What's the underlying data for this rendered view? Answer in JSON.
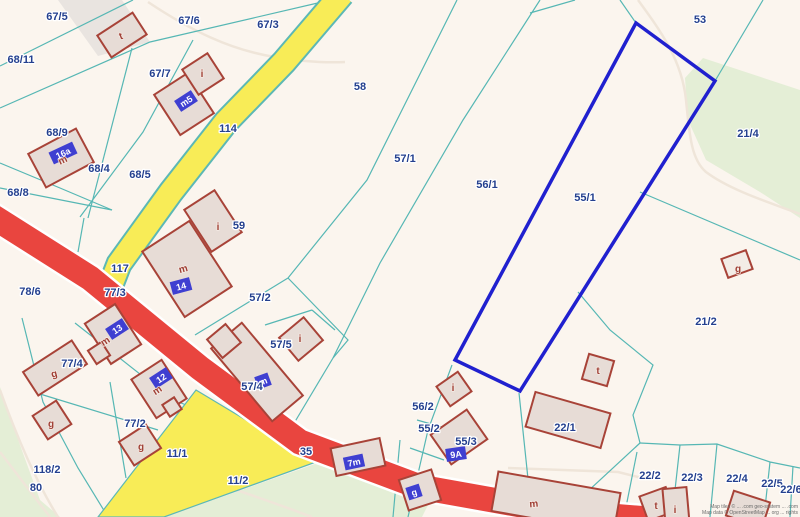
{
  "map": {
    "colors": {
      "background": "#fbf5ee",
      "green": "#e4eed6",
      "gray_band": "#e9e4e0",
      "parcel_line": "#56b7b4",
      "road_yellow": "#f8ec57",
      "road_yellow_casing": "#5cb8b5",
      "road_red": "#e9453f",
      "road_red_casing": "#ffffff",
      "selected_outline": "#2020cf",
      "building_fill": "#e7dcd6",
      "building_stroke": "#a84338",
      "badge_fill": "#3f3fd1",
      "label_color": "#24408f",
      "letter_color": "#a04036",
      "path_color": "#efe5d9"
    },
    "areas": [
      {
        "name": "green-area-bottom-left",
        "points": [
          [
            0,
            387
          ],
          [
            20,
            445
          ],
          [
            40,
            500
          ],
          [
            60,
            517
          ],
          [
            0,
            517
          ]
        ],
        "fill": "#e4eed6"
      },
      {
        "name": "green-area-parcel-11-2",
        "points": [
          [
            165,
            517
          ],
          [
            315,
            464
          ],
          [
            430,
            501
          ],
          [
            422,
            517
          ]
        ],
        "fill": "#e4eed6"
      },
      {
        "name": "green-area-top-right",
        "points": [
          [
            703,
            58
          ],
          [
            800,
            90
          ],
          [
            800,
            218
          ],
          [
            760,
            192
          ],
          [
            706,
            160
          ],
          [
            688,
            120
          ],
          [
            685,
            78
          ]
        ],
        "fill": "#e4eed6"
      },
      {
        "name": "gray-track-top-left",
        "points": [
          [
            58,
            0
          ],
          [
            122,
            0
          ],
          [
            150,
            42
          ],
          [
            98,
            56
          ]
        ],
        "fill": "#e9e4e0"
      }
    ],
    "faint_paths": [
      {
        "name": "path-top-left",
        "d": "M148,2 C190,30 230,50 275,57 C305,62 325,63 345,62"
      },
      {
        "name": "path-near-53",
        "d": "M638,0 C660,30 682,60 686,100 C690,140 692,160 706,172 C730,190 768,202 800,214"
      },
      {
        "name": "path-green-edge",
        "d": "M0,390 C18,440 38,485 58,517"
      },
      {
        "name": "path-green-inner",
        "d": "M0,452 C20,478 35,498 50,517"
      },
      {
        "name": "path-green-11-2",
        "d": "M180,472 C230,487 272,502 312,517"
      },
      {
        "name": "path-above-building-m",
        "d": "M508,468 L618,472 L642,478"
      }
    ],
    "parcel_lines": [
      [
        [
          0,
          66
        ],
        [
          133,
          0
        ]
      ],
      [
        [
          0,
          108
        ],
        [
          150,
          42
        ],
        [
          322,
          2
        ]
      ],
      [
        [
          0,
          188
        ],
        [
          112,
          210
        ]
      ],
      [
        [
          0,
          163
        ],
        [
          60,
          188
        ],
        [
          112,
          210
        ]
      ],
      [
        [
          132,
          48
        ],
        [
          88,
          218
        ]
      ],
      [
        [
          193,
          40
        ],
        [
          143,
          132
        ],
        [
          80,
          217
        ]
      ],
      [
        [
          84,
          218
        ],
        [
          78,
          252
        ]
      ],
      [
        [
          457,
          0
        ],
        [
          367,
          180
        ],
        [
          288,
          278
        ]
      ],
      [
        [
          540,
          0
        ],
        [
          463,
          120
        ],
        [
          380,
          263
        ],
        [
          333,
          358
        ]
      ],
      [
        [
          530,
          13
        ],
        [
          575,
          0
        ]
      ],
      [
        [
          620,
          0
        ],
        [
          636,
          23
        ]
      ],
      [
        [
          715,
          81
        ],
        [
          763,
          0
        ]
      ],
      [
        [
          640,
          192
        ],
        [
          800,
          260
        ]
      ],
      [
        [
          578,
          292
        ],
        [
          610,
          330
        ],
        [
          653,
          365
        ],
        [
          633,
          415
        ],
        [
          640,
          443
        ]
      ],
      [
        [
          640,
          443
        ],
        [
          560,
          517
        ]
      ],
      [
        [
          637,
          452
        ],
        [
          624,
          517
        ]
      ],
      [
        [
          640,
          443
        ],
        [
          680,
          445
        ],
        [
          717,
          444
        ],
        [
          770,
          462
        ],
        [
          800,
          468
        ]
      ],
      [
        [
          680,
          445
        ],
        [
          672,
          517
        ]
      ],
      [
        [
          717,
          444
        ],
        [
          710,
          517
        ]
      ],
      [
        [
          770,
          462
        ],
        [
          764,
          517
        ]
      ],
      [
        [
          793,
          466
        ],
        [
          790,
          517
        ]
      ],
      [
        [
          288,
          278
        ],
        [
          195,
          335
        ]
      ],
      [
        [
          288,
          278
        ],
        [
          348,
          340
        ],
        [
          333,
          358
        ]
      ],
      [
        [
          333,
          358
        ],
        [
          290,
          430
        ]
      ],
      [
        [
          452,
          365
        ],
        [
          428,
          430
        ],
        [
          412,
          500
        ],
        [
          408,
          517
        ]
      ],
      [
        [
          400,
          440
        ],
        [
          393,
          517
        ]
      ],
      [
        [
          417,
          420
        ],
        [
          452,
          430
        ]
      ],
      [
        [
          410,
          448
        ],
        [
          444,
          460
        ]
      ],
      [
        [
          519,
          393
        ],
        [
          532,
          517
        ]
      ],
      [
        [
          22,
          318
        ],
        [
          43,
          402
        ],
        [
          78,
          468
        ],
        [
          108,
          517
        ]
      ],
      [
        [
          40,
          394
        ],
        [
          158,
          430
        ]
      ],
      [
        [
          75,
          323
        ],
        [
          173,
          400
        ],
        [
          205,
          412
        ]
      ],
      [
        [
          110,
          382
        ],
        [
          126,
          478
        ]
      ],
      [
        [
          265,
          325
        ],
        [
          312,
          310
        ]
      ],
      [
        [
          312,
          310
        ],
        [
          335,
          330
        ]
      ]
    ],
    "roads": {
      "yellow_main": {
        "name": "road-yellow-114",
        "d": "M342,-6 L284,62 L226,122 L171,192 L119,264 L112,282",
        "width": 23,
        "casing": 27
      },
      "yellow_branch": {
        "name": "road-yellow-11-1",
        "points": [
          [
            196,
            390
          ],
          [
            316,
            462
          ],
          [
            164,
            517
          ],
          [
            98,
            517
          ]
        ]
      },
      "red_main": {
        "name": "road-red-35",
        "d": "M-8,216 L90,278 L200,368 L300,442 L420,487 L560,512 L648,519",
        "width": 25,
        "casing": 30
      }
    },
    "selected_parcel": {
      "label": "55/1",
      "points": [
        [
          636,
          23
        ],
        [
          715,
          81
        ],
        [
          520,
          391
        ],
        [
          455,
          360
        ]
      ]
    },
    "buildings": [
      {
        "cx": 122,
        "cy": 35,
        "w": 42,
        "h": 26,
        "rot": -33
      },
      {
        "cx": 184,
        "cy": 104,
        "w": 40,
        "h": 48,
        "rot": -33
      },
      {
        "cx": 203,
        "cy": 74,
        "w": 30,
        "h": 30,
        "rot": -33
      },
      {
        "cx": 61,
        "cy": 158,
        "w": 54,
        "h": 38,
        "rot": -28
      },
      {
        "cx": 213,
        "cy": 221,
        "w": 36,
        "h": 50,
        "rot": -33
      },
      {
        "cx": 187,
        "cy": 269,
        "w": 56,
        "h": 78,
        "rot": -33
      },
      {
        "cx": 113,
        "cy": 334,
        "w": 36,
        "h": 48,
        "rot": -33
      },
      {
        "cx": 99,
        "cy": 353,
        "w": 16,
        "h": 16,
        "rot": -33
      },
      {
        "cx": 159,
        "cy": 389,
        "w": 36,
        "h": 46,
        "rot": -33
      },
      {
        "cx": 172,
        "cy": 407,
        "w": 14,
        "h": 14,
        "rot": -33
      },
      {
        "cx": 55,
        "cy": 368,
        "w": 58,
        "h": 28,
        "rot": -33
      },
      {
        "cx": 52,
        "cy": 420,
        "w": 28,
        "h": 28,
        "rot": -33
      },
      {
        "cx": 140,
        "cy": 445,
        "w": 32,
        "h": 28,
        "rot": -33
      },
      {
        "cx": 257,
        "cy": 372,
        "w": 40,
        "h": 95,
        "rot": -40
      },
      {
        "cx": 224,
        "cy": 341,
        "w": 24,
        "h": 24,
        "rot": -40
      },
      {
        "cx": 301,
        "cy": 339,
        "w": 32,
        "h": 30,
        "rot": -40
      },
      {
        "cx": 358,
        "cy": 457,
        "w": 50,
        "h": 28,
        "rot": -12
      },
      {
        "cx": 420,
        "cy": 490,
        "w": 34,
        "h": 32,
        "rot": -18
      },
      {
        "cx": 459,
        "cy": 437,
        "w": 44,
        "h": 36,
        "rot": -35
      },
      {
        "cx": 454,
        "cy": 389,
        "w": 26,
        "h": 24,
        "rot": -35
      },
      {
        "cx": 568,
        "cy": 420,
        "w": 78,
        "h": 36,
        "rot": 16
      },
      {
        "cx": 598,
        "cy": 370,
        "w": 26,
        "h": 26,
        "rot": 16
      },
      {
        "cx": 556,
        "cy": 502,
        "w": 124,
        "h": 40,
        "rot": 10
      },
      {
        "cx": 657,
        "cy": 504,
        "w": 28,
        "h": 26,
        "rot": -20
      },
      {
        "cx": 676,
        "cy": 506,
        "w": 24,
        "h": 36,
        "rot": -5
      },
      {
        "cx": 748,
        "cy": 509,
        "w": 38,
        "h": 26,
        "rot": 18
      },
      {
        "cx": 737,
        "cy": 264,
        "w": 26,
        "h": 20,
        "rot": -20,
        "fill": "#f3ece6"
      }
    ],
    "address_badges": [
      {
        "text": "m5",
        "x": 186,
        "y": 101,
        "rot": -33
      },
      {
        "text": "16a",
        "x": 63,
        "y": 153,
        "rot": -25
      },
      {
        "text": "14",
        "x": 181,
        "y": 286,
        "rot": -15
      },
      {
        "text": "13",
        "x": 117,
        "y": 329,
        "rot": -33
      },
      {
        "text": "12",
        "x": 161,
        "y": 378,
        "rot": -33
      },
      {
        "text": "m",
        "x": 263,
        "y": 381,
        "rot": -20
      },
      {
        "text": "7m",
        "x": 354,
        "y": 462,
        "rot": -12
      },
      {
        "text": "g",
        "x": 414,
        "y": 492,
        "rot": -18
      },
      {
        "text": "9A",
        "x": 456,
        "y": 454,
        "rot": -8
      }
    ],
    "building_letters": [
      {
        "text": "t",
        "x": 122,
        "y": 39,
        "rot": -20
      },
      {
        "text": "i",
        "x": 202,
        "y": 77,
        "rot": 0
      },
      {
        "text": "m",
        "x": 64,
        "y": 163,
        "rot": -25
      },
      {
        "text": "i",
        "x": 218,
        "y": 230,
        "rot": 0
      },
      {
        "text": "m",
        "x": 184,
        "y": 272,
        "rot": -15
      },
      {
        "text": "m",
        "x": 107,
        "y": 344,
        "rot": -33
      },
      {
        "text": "m",
        "x": 159,
        "y": 393,
        "rot": -33
      },
      {
        "text": "g",
        "x": 55,
        "y": 377,
        "rot": -15
      },
      {
        "text": "g",
        "x": 51,
        "y": 427,
        "rot": 0
      },
      {
        "text": "g",
        "x": 141,
        "y": 450,
        "rot": 0
      },
      {
        "text": "i",
        "x": 300,
        "y": 342,
        "rot": 0
      },
      {
        "text": "i",
        "x": 453,
        "y": 391,
        "rot": 0
      },
      {
        "text": "t",
        "x": 598,
        "y": 374,
        "rot": 0
      },
      {
        "text": "g",
        "x": 738,
        "y": 272,
        "rot": 0
      },
      {
        "text": "m",
        "x": 534,
        "y": 507,
        "rot": -5
      },
      {
        "text": "t",
        "x": 656,
        "y": 509,
        "rot": 0
      },
      {
        "text": "i",
        "x": 675,
        "y": 513,
        "rot": 0
      }
    ],
    "parcel_labels": [
      {
        "text": "67/5",
        "x": 57,
        "y": 20
      },
      {
        "text": "67/6",
        "x": 189,
        "y": 24
      },
      {
        "text": "67/3",
        "x": 268,
        "y": 28
      },
      {
        "text": "53",
        "x": 700,
        "y": 23
      },
      {
        "text": "68/11",
        "x": 21,
        "y": 63
      },
      {
        "text": "67/7",
        "x": 160,
        "y": 77
      },
      {
        "text": "58",
        "x": 360,
        "y": 90
      },
      {
        "text": "114",
        "x": 228,
        "y": 132
      },
      {
        "text": "68/9",
        "x": 57,
        "y": 136
      },
      {
        "text": "21/4",
        "x": 748,
        "y": 137
      },
      {
        "text": "68/4",
        "x": 99,
        "y": 172
      },
      {
        "text": "68/5",
        "x": 140,
        "y": 178
      },
      {
        "text": "68/8",
        "x": 18,
        "y": 196
      },
      {
        "text": "57/1",
        "x": 405,
        "y": 162
      },
      {
        "text": "56/1",
        "x": 487,
        "y": 188
      },
      {
        "text": "55/1",
        "x": 585,
        "y": 201
      },
      {
        "text": "117",
        "x": 120,
        "y": 272
      },
      {
        "text": "59",
        "x": 239,
        "y": 229
      },
      {
        "text": "78/6",
        "x": 30,
        "y": 295
      },
      {
        "text": "77/3",
        "x": 115,
        "y": 296
      },
      {
        "text": "57/2",
        "x": 260,
        "y": 301
      },
      {
        "text": "21/2",
        "x": 706,
        "y": 325
      },
      {
        "text": "57/5",
        "x": 281,
        "y": 348
      },
      {
        "text": "77/4",
        "x": 72,
        "y": 367
      },
      {
        "text": "57/4",
        "x": 252,
        "y": 390
      },
      {
        "text": "56/2",
        "x": 423,
        "y": 410
      },
      {
        "text": "77/2",
        "x": 135,
        "y": 427
      },
      {
        "text": "55/2",
        "x": 429,
        "y": 432
      },
      {
        "text": "55/3",
        "x": 466,
        "y": 445
      },
      {
        "text": "11/1",
        "x": 177,
        "y": 457
      },
      {
        "text": "22/1",
        "x": 565,
        "y": 431
      },
      {
        "text": "118/2",
        "x": 47,
        "y": 473
      },
      {
        "text": "35",
        "x": 306,
        "y": 455
      },
      {
        "text": "80",
        "x": 36,
        "y": 491
      },
      {
        "text": "11/2",
        "x": 238,
        "y": 484
      },
      {
        "text": "22/2",
        "x": 650,
        "y": 479
      },
      {
        "text": "22/3",
        "x": 692,
        "y": 481
      },
      {
        "text": "22/4",
        "x": 737,
        "y": 482
      },
      {
        "text": "22/5",
        "x": 772,
        "y": 487
      },
      {
        "text": "22/6",
        "x": 791,
        "y": 493
      }
    ],
    "attribution": {
      "line1": "Map tiles © ... .com geo-system ... .com",
      "line2": "Map data © OpenStreetMap ... org ... rights"
    }
  }
}
